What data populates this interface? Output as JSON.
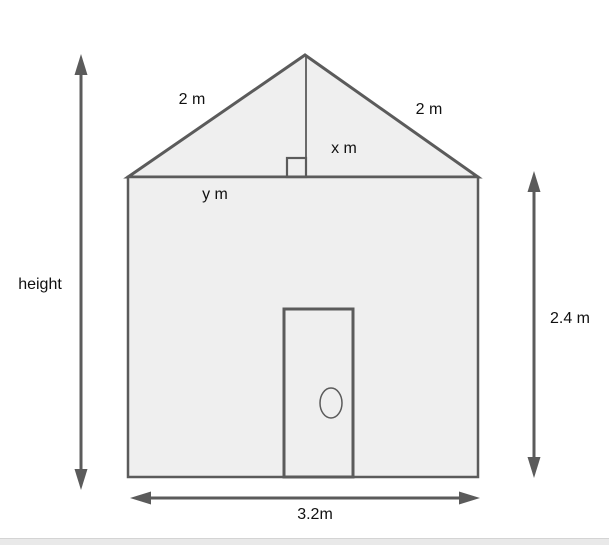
{
  "figure": {
    "description": "House front elevation with roof triangle and dimension arrows",
    "labels": {
      "roof_left": "2 m",
      "roof_right": "2 m",
      "roof_rise": "x m",
      "roof_base": "y m",
      "total_height": "height",
      "wall_height": "2.4 m",
      "base_width": "3.2m"
    },
    "colors": {
      "shape_fill": "#efefef",
      "shape_stroke": "#5b5b5b",
      "arrow": "#5b5b5b",
      "label_text": "#111111",
      "page_background": "#ffffff",
      "bottom_bar_fill": "#e9e9e9",
      "bottom_bar_border": "#d4d4d4"
    }
  }
}
